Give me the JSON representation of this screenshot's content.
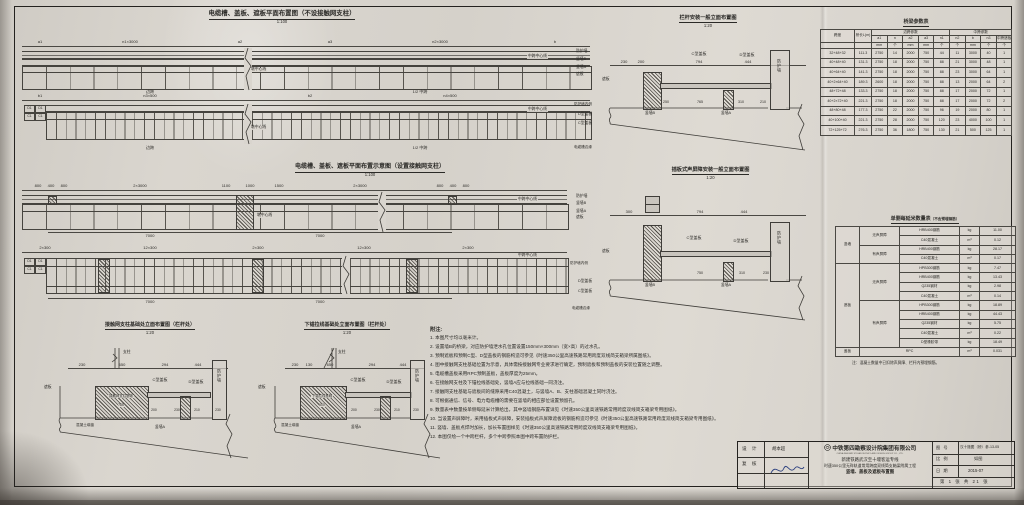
{
  "colors": {
    "paper": "#dad6cf",
    "ink": "#2b2a27",
    "line": "#45433e",
    "signature_ink": "#2b3f7e"
  },
  "plan_top": {
    "title": "电缆槽、盖板、遮板平面布置图（不设接触网支柱）",
    "scale": "1:100",
    "dims1": [
      "a1",
      "n1×3000",
      "a2",
      "a3",
      "n2×3000",
      "b"
    ],
    "dims2": [
      "b1",
      "n3×500",
      "b2",
      "n4×500"
    ],
    "pier_cl": "墩中心线",
    "mid_cl": "中跨中心线",
    "span_left": "边跨",
    "span_right": "1/2 中跨",
    "side1": [
      "防护墙",
      "竖墙B",
      "竖墙A",
      "遮板"
    ],
    "side2": [
      "防护墙内侧",
      "D型盖板",
      "C型盖板",
      "电缆槽边缘"
    ],
    "cells": [
      "D1",
      "D1",
      "C1",
      "C1"
    ]
  },
  "plan_mid": {
    "title": "电缆槽、盖板、遮板平面布置示意图（设置接触网支柱）",
    "scale": "1:100",
    "dims3": [
      "800",
      "400",
      "800",
      "2×3000",
      "1100",
      "1000",
      "1500",
      "2×3000",
      "800",
      "400",
      "800"
    ],
    "dims3b": [
      "7000",
      "7000"
    ],
    "dims4": [
      "2×300",
      "12×300",
      "2×300",
      "12×300",
      "2×300"
    ],
    "dims4b": [
      "7000",
      "7000"
    ],
    "pier_cl": "墩中心线",
    "mid_cl": "中跨中心线",
    "side1": [
      "防护墙",
      "竖墙B",
      "竖墙A",
      "遮板"
    ],
    "side2": [
      "防护墙内侧",
      "D型盖板",
      "C型盖板",
      "电缆槽边缘"
    ],
    "cells": [
      "D1",
      "D1",
      "C1",
      "C1"
    ]
  },
  "elev1": {
    "title": "栏杆安装一般立面布置图",
    "scale": "1:20",
    "d1": "230",
    "d2": "200",
    "cover_c": "C型盖板",
    "dc": "794",
    "cover_d": "D型盖板",
    "dd": "444",
    "wall": "防护墙",
    "zb": "遮板",
    "wa": "竖墙A",
    "wb": "竖墙B",
    "db": [
      "250",
      "765",
      "310",
      "210"
    ]
  },
  "elev2": {
    "title": "插板式声屏障安装一般立面布置图",
    "scale": "1:20",
    "d1": "300",
    "d2": "200",
    "cover_c": "C型盖板",
    "dc": "794",
    "cover_d": "D型盖板",
    "dd": "444",
    "wall": "防护墙",
    "zb": "遮板",
    "wa": "竖墙A",
    "wb": "竖墙B",
    "db": [
      "750",
      "310",
      "230"
    ]
  },
  "detail1": {
    "title": "接触网支柱基础处立面布置图（栏杆处）",
    "scale": "1:20",
    "mast": "支柱",
    "dims": [
      "230",
      "650",
      "294",
      "444"
    ],
    "found": "接触网支柱基础",
    "found_dim": "785",
    "cover_c": "C型盖板",
    "cover_d": "D型盖板",
    "wall": "防护墙",
    "zb": "遮板",
    "wa": "竖墙A",
    "seal": "混凝土填缝",
    "db": [
      "200",
      "230",
      "210",
      "230"
    ]
  },
  "detail2": {
    "title": "下锚拉线基础处立面布置图（栏杆处）",
    "scale": "1:20",
    "mast": "支柱",
    "dims": [
      "230",
      "130",
      "650",
      "294",
      "444"
    ],
    "found": "下锚拉线基础",
    "found_dim": "600",
    "cover_c": "C型盖板",
    "cover_d": "D型盖板",
    "wall": "防护墙",
    "zb": "遮板",
    "wa": "竖墙A",
    "seal": "混凝土填缝",
    "db": [
      "200",
      "230",
      "210",
      "230"
    ]
  },
  "param_table": {
    "title": "桥梁参数表",
    "col_span": "跨度",
    "col_len": "桥长L(m)",
    "grp_side": "边跨参数",
    "grp_mid": "中跨参数",
    "sub": [
      "a1",
      "n",
      "a2",
      "a3",
      "n1",
      "n2",
      "b",
      "n3",
      "中跨遮板"
    ],
    "units": [
      "mm",
      "个",
      "mm",
      "mm",
      "个",
      "个",
      "mm",
      "个",
      "个"
    ],
    "rows": [
      [
        "32+48+32",
        "111.3",
        "2750",
        "14",
        "2000",
        "750",
        "44",
        "11",
        "3000",
        "40",
        "1"
      ],
      [
        "40+48+40",
        "131.3",
        "2750",
        "18",
        "2000",
        "750",
        "88",
        "21",
        "3000",
        "48",
        "1"
      ],
      [
        "40+64+40",
        "141.3",
        "2750",
        "18",
        "2000",
        "750",
        "88",
        "23",
        "3000",
        "64",
        "1"
      ],
      [
        "40+2×64+40",
        "189.3",
        "2600",
        "18",
        "2000",
        "750",
        "88",
        "13",
        "2000",
        "64",
        "2"
      ],
      [
        "48+72+48",
        "133.3",
        "2750",
        "18",
        "2000",
        "750",
        "88",
        "17",
        "2000",
        "72",
        "1"
      ],
      [
        "40+2×72+40",
        "221.3",
        "2750",
        "18",
        "2000",
        "750",
        "88",
        "17",
        "2000",
        "72",
        "2"
      ],
      [
        "48+80+48",
        "177.3",
        "2750",
        "22",
        "2000",
        "750",
        "96",
        "19",
        "2000",
        "80",
        "1"
      ],
      [
        "40+100+40",
        "221.3",
        "2750",
        "28",
        "2000",
        "750",
        "120",
        "23",
        "4000",
        "100",
        "1"
      ],
      [
        "72+125+72",
        "276.3",
        "2750",
        "36",
        "1800",
        "750",
        "130",
        "21",
        "500",
        "125",
        "1"
      ]
    ]
  },
  "qty_table": {
    "title": "单侧每延米数量表",
    "suffix": "（不含预埋钢筋）",
    "rows": [
      {
        "part": "竖墙",
        "ps": 4,
        "cat": "无声屏障",
        "cs": 2,
        "mat": "HRB400钢筋",
        "unit": "kg",
        "qty": "11.00"
      },
      {
        "mat": "C40混凝土",
        "unit": "m³",
        "qty": "0.12"
      },
      {
        "cat": "有声屏障",
        "cs": 2,
        "mat": "HRB400钢筋",
        "unit": "kg",
        "qty": "28.17"
      },
      {
        "mat": "C40混凝土",
        "unit": "m³",
        "qty": "0.17"
      },
      {
        "part": "遮板",
        "ps": 9,
        "cat": "无声屏障",
        "cs": 4,
        "mat": "HPB300钢筋",
        "unit": "kg",
        "qty": "7.47"
      },
      {
        "mat": "HRB400钢筋",
        "unit": "kg",
        "qty": "13.43"
      },
      {
        "mat": "Q235钢材",
        "unit": "kg",
        "qty": "2.98"
      },
      {
        "mat": "C40混凝土",
        "unit": "m³",
        "qty": "0.14"
      },
      {
        "cat": "有声屏障",
        "cs": 5,
        "mat": "HPB300钢筋",
        "unit": "kg",
        "qty": "18.89"
      },
      {
        "mat": "HRB400钢筋",
        "unit": "kg",
        "qty": "44.43"
      },
      {
        "mat": "Q235钢材",
        "unit": "kg",
        "qty": "5.75"
      },
      {
        "mat": "C40混凝土",
        "unit": "m³",
        "qty": "0.22"
      },
      {
        "mat": "D型橡胶带",
        "unit": "kg",
        "qty": "18.49"
      },
      {
        "part": "盖板",
        "ps": 1,
        "catmat": "RPC",
        "unit": "m³",
        "qty": "0.031"
      }
    ],
    "note": "注：混凝土数量中已扣除声屏障、栏杆内预埋钢筋。"
  },
  "notes": {
    "heading": "附注:",
    "items": [
      "本图尺寸均以毫米计。",
      "设置墙B的桥梁，对应防护墙泄水孔位置设置150mm×300mm（宽×高）的过水孔。",
      "预制遮板和预制C型、D型盖板的钢筋构造可参见《时速350公里高速铁路常用跨度双线简支箱梁所属图纸》。",
      "图中接触网支柱基础位置为示意，具体需按接触网专业要求进行确定，预制遮板和预制盖板的安装位置随之调整。",
      "电缆槽盖板采用RPC预制盖板，盖板厚度为25mm。",
      "在接触网支柱及下锚拉线基础处，竖墙A应与拉线基础一同浇注。",
      "接触网支柱基础与遮板间的缝隙采用C40混凝土，与竖墙A、B、支柱基础混凝土同时浇注。",
      "可根据通信、信号、电力电缆槽的需要在竖墙的相应部位设置预留孔。",
      "数量表中数量按单侧每延米计算给出，其中竖墙钢筋布置详见《时速350公里高速铁路常用跨度双线简支箱梁专用图纸》。",
      "当设置声屏障时，采用插板式声屏障，安装插板式声屏障遮板的钢筋构造可参见《时速350公里高速铁路常用跨度双线简支箱梁专用图纸》。",
      "竖墙、盖板点焊时加长，加长布置图样见《时速350公里高速铁路常用跨度双线简支箱梁专用图纸》。",
      "本图仅绘一个中跨栏杆，多个中跨参照本图中跨布置防护栏。"
    ]
  },
  "title_block": {
    "design_label": "设 计",
    "check_label": "复 核",
    "designer": "胡本超",
    "company": "中铁第四勘察设计院集团有限公司",
    "company_en": "CHINA RAILWAY SIYUAN SURVEY AND DESIGN GROUP CO., LTD.",
    "project_line1": "新建铁路武汉至十堰客运专线",
    "project_line2": "时速350公里无砟轨道常用跨度双线简支箱梁附属工程",
    "sheet_title": "竖墙、盖板及遮板布置图",
    "fig_no_label": "图 号",
    "fig_no": "汉十施图（桥）参-13-05",
    "scale_label": "比 例",
    "scale_val": "如图",
    "date_label": "日 期",
    "date_val": "2015-07",
    "sheet_info": "第 1 张 共 21 张"
  }
}
